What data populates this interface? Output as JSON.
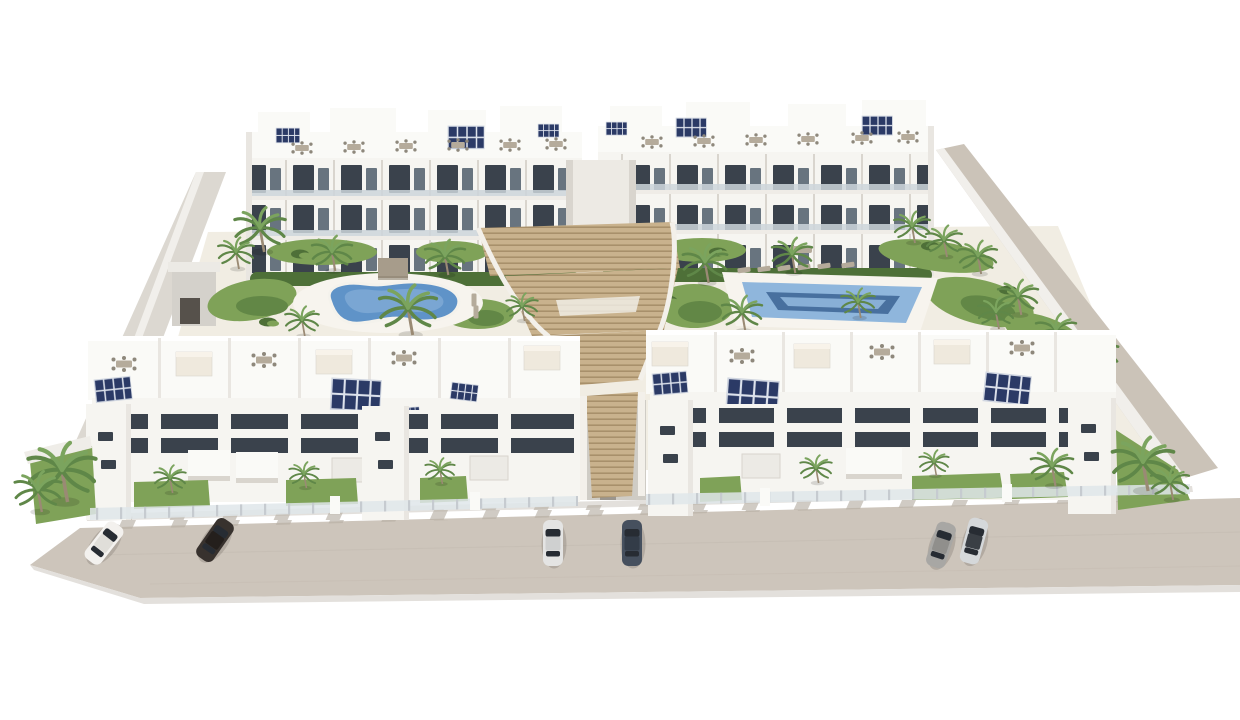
{
  "scene": {
    "description": "Aerial 3D architectural rendering of a white residential apartment complex: two rear three-storey blocks and two front three-storey blocks with rooftop terraces, outdoor furniture and solar panels, a landscaped courtyard with a kidney-shaped pool and a rectangular pool, a central timber amphitheatre staircase, palm trees and lawns, and six cars parked on the beige street in the foreground.",
    "buildings": {
      "rear_blocks": 2,
      "front_blocks": 2,
      "storeys": 3,
      "rooftop_terraces": true
    },
    "solar_panel_arrays": 13,
    "pools": {
      "kidney_shaped": 1,
      "rectangular": 1
    },
    "staircase": "central terraced timber steps between the building rows",
    "vehicles": {
      "count": 6,
      "colors": [
        "white",
        "black",
        "silver",
        "dark-gray",
        "gray",
        "silver-dark-roof"
      ]
    },
    "vegetation": {
      "palm_trees": 30,
      "lawns": true,
      "garden_beds": true,
      "hedges": true
    },
    "street": {
      "position": "foreground",
      "parked_cars": 6
    }
  },
  "palette": {
    "background": "#ffffff",
    "building_white": "#f6f5f1",
    "building_shade": "#e9e6e1",
    "building_shadow": "#d9d5ce",
    "roof_white": "#fafaf7",
    "window_dark": "#3a424c",
    "window_glass": "#68747f",
    "railing_glass": "#ccd5db",
    "solar_navy": "#2b3a66",
    "furniture_tan": "#b5ab9b",
    "furniture_gray": "#8e887c",
    "canopy_cream": "#efe9dd",
    "pool_water": "#5f93c8",
    "pool_water_light": "#8fb6dc",
    "pool_lane_dark": "#48709f",
    "pool_deck": "#f7f4ee",
    "deck_cream": "#f1ede3",
    "lawn_green": "#7fa258",
    "lawn_dark": "#628746",
    "bush_green": "#4e7038",
    "palm_green": "#5f8748",
    "palm_light": "#7ba45e",
    "trunk_brown": "#9a8a74",
    "stair_tan": "#c9b28d",
    "stair_line": "#a8906b",
    "stair_side": "#f3f0ea",
    "road_beige": "#cdc5bb",
    "road_shadow": "#e3e0dc",
    "wall_beige": "#cbc3b8",
    "wall_light": "#dcd8d1",
    "fence_glass": "#dfe6ea",
    "car_white_body": "#f3f1ee",
    "car_white_roof": "#e0ded9",
    "car_black_body": "#38322e",
    "car_black_roof": "#241f1c",
    "car_silver_body": "#e4e4e3",
    "car_silver_roof": "#cfd0d0",
    "car_navy_body": "#46505e",
    "car_navy_roof": "#333c48",
    "car_gray_body": "#a8a7a4",
    "car_gray_roof": "#908f8c",
    "car_silver2_body": "#d5d8da",
    "car_silver2_roof": "#3a3f45"
  }
}
